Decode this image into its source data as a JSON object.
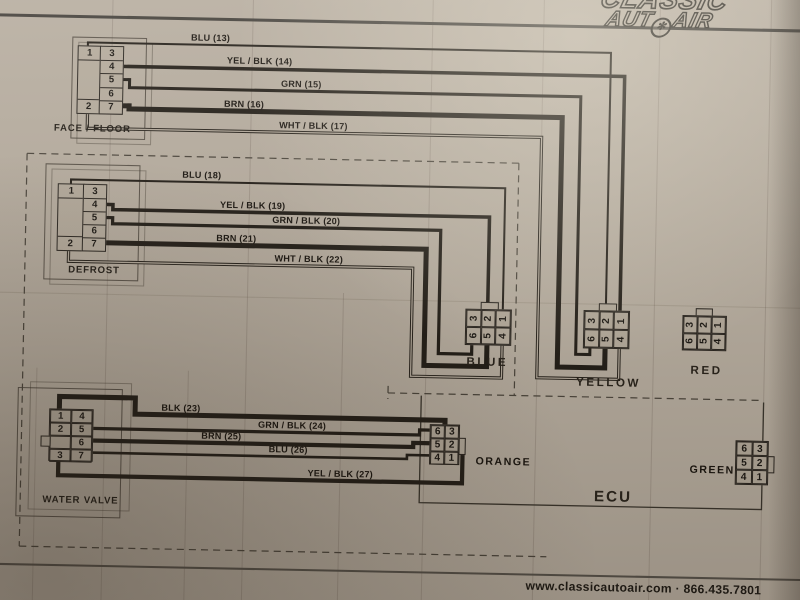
{
  "title": "Wiring Schematic / REVERSE",
  "logo": {
    "line1": "CLASSIC",
    "line2_left": "AUT",
    "line2_right": "AIR"
  },
  "footer": {
    "contact": "www.classicautoair.com · 866.435.7801"
  },
  "ecu": {
    "label": "ECU"
  },
  "sections": {
    "face_floor": {
      "label": "FACE / FLOOR",
      "left_pins": [
        "1",
        "2"
      ],
      "right_pins": [
        "3",
        "4",
        "5",
        "6",
        "7"
      ],
      "wires": [
        "BLU (13)",
        "YEL / BLK (14)",
        "GRN (15)",
        "BRN (16)",
        "WHT / BLK (17)"
      ]
    },
    "defrost": {
      "label": "DEFROST",
      "left_pins": [
        "1",
        "2"
      ],
      "right_pins": [
        "3",
        "4",
        "5",
        "6",
        "7"
      ],
      "wires": [
        "BLU (18)",
        "YEL / BLK (19)",
        "GRN / BLK (20)",
        "BRN (21)",
        "WHT / BLK (22)"
      ]
    },
    "water_valve": {
      "label": "WATER VALVE",
      "left_pins": [
        "1",
        "2",
        "",
        "3"
      ],
      "right_pins": [
        "4",
        "5",
        "6",
        "7"
      ],
      "wires": [
        "BLK (23)",
        "GRN / BLK (24)",
        "BRN (25)",
        "BLU (26)",
        "YEL / BLK (27)"
      ]
    }
  },
  "connectors": {
    "blue": {
      "label": "BLUE",
      "pins": [
        "3",
        "2",
        "1",
        "6",
        "5",
        "4"
      ]
    },
    "yellow": {
      "label": "YELLOW",
      "pins": [
        "3",
        "2",
        "1",
        "6",
        "5",
        "4"
      ]
    },
    "red": {
      "label": "RED",
      "pins": [
        "3",
        "2",
        "1",
        "6",
        "5",
        "4"
      ]
    },
    "orange": {
      "label": "ORANGE",
      "pins": [
        "6",
        "3",
        "5",
        "2",
        "4",
        "1"
      ]
    },
    "green": {
      "label": "GREEN",
      "pins": [
        "6",
        "3",
        "5",
        "2",
        "4",
        "1"
      ]
    }
  }
}
